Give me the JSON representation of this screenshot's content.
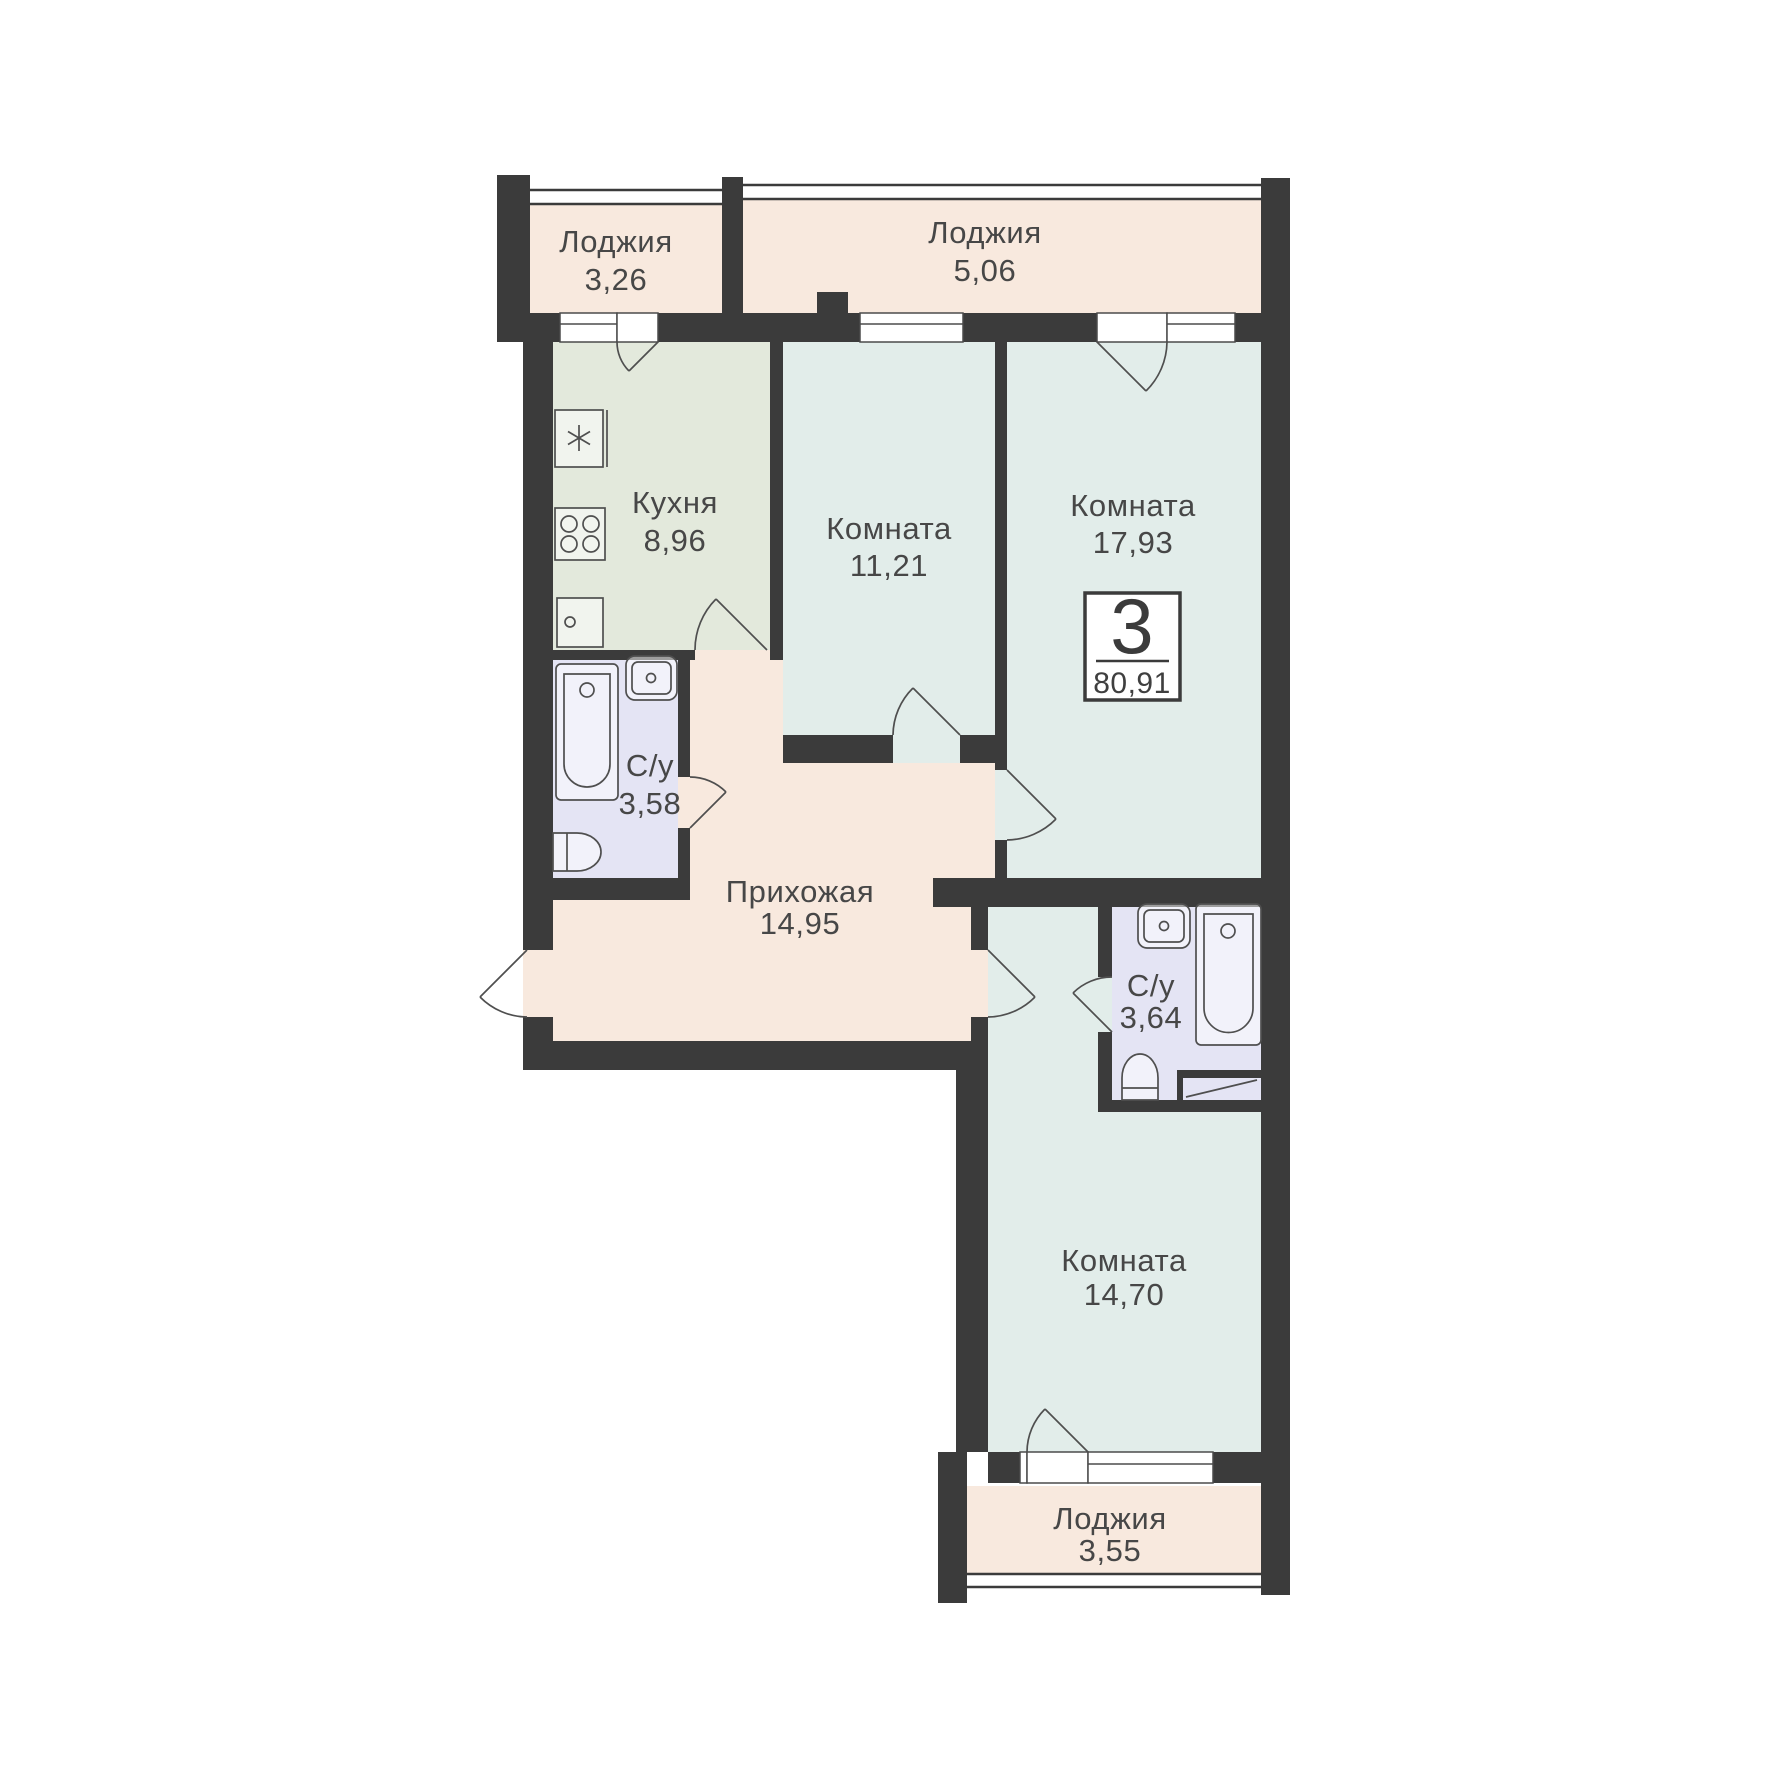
{
  "plan": {
    "title": "3-room apartment floor plan",
    "badge": {
      "rooms_count": "3",
      "total_area": "80,91"
    },
    "rooms": {
      "loggia_top_left": {
        "name": "Лоджия",
        "area": "3,26"
      },
      "loggia_top_right": {
        "name": "Лоджия",
        "area": "5,06"
      },
      "kitchen": {
        "name": "Кухня",
        "area": "8,96"
      },
      "room_small": {
        "name": "Комната",
        "area": "11,21"
      },
      "room_large": {
        "name": "Комната",
        "area": "17,93"
      },
      "bathroom_upper": {
        "name": "С/у",
        "area": "3,58"
      },
      "hallway": {
        "name": "Прихожая",
        "area": "14,95"
      },
      "bathroom_lower": {
        "name": "С/у",
        "area": "3,64"
      },
      "room_bottom": {
        "name": "Комната",
        "area": "14,70"
      },
      "loggia_bottom": {
        "name": "Лоджия",
        "area": "3,55"
      }
    },
    "colors": {
      "wall": "#3b3b3b",
      "floor_warm": "#f8e9de",
      "floor_kitchen": "#e3e9dc",
      "floor_room": "#e2edea",
      "floor_bath": "#e4e4f4",
      "line": "#4f4f4f",
      "text": "#474747",
      "white": "#ffffff"
    },
    "symbols": [
      "fridge-symbol",
      "stove-symbol",
      "kitchen-sink-symbol",
      "bathtub-symbol",
      "washbasin-symbol",
      "toilet-symbol",
      "washer-niche-symbol",
      "door-arc-symbol",
      "window-symbol"
    ]
  }
}
